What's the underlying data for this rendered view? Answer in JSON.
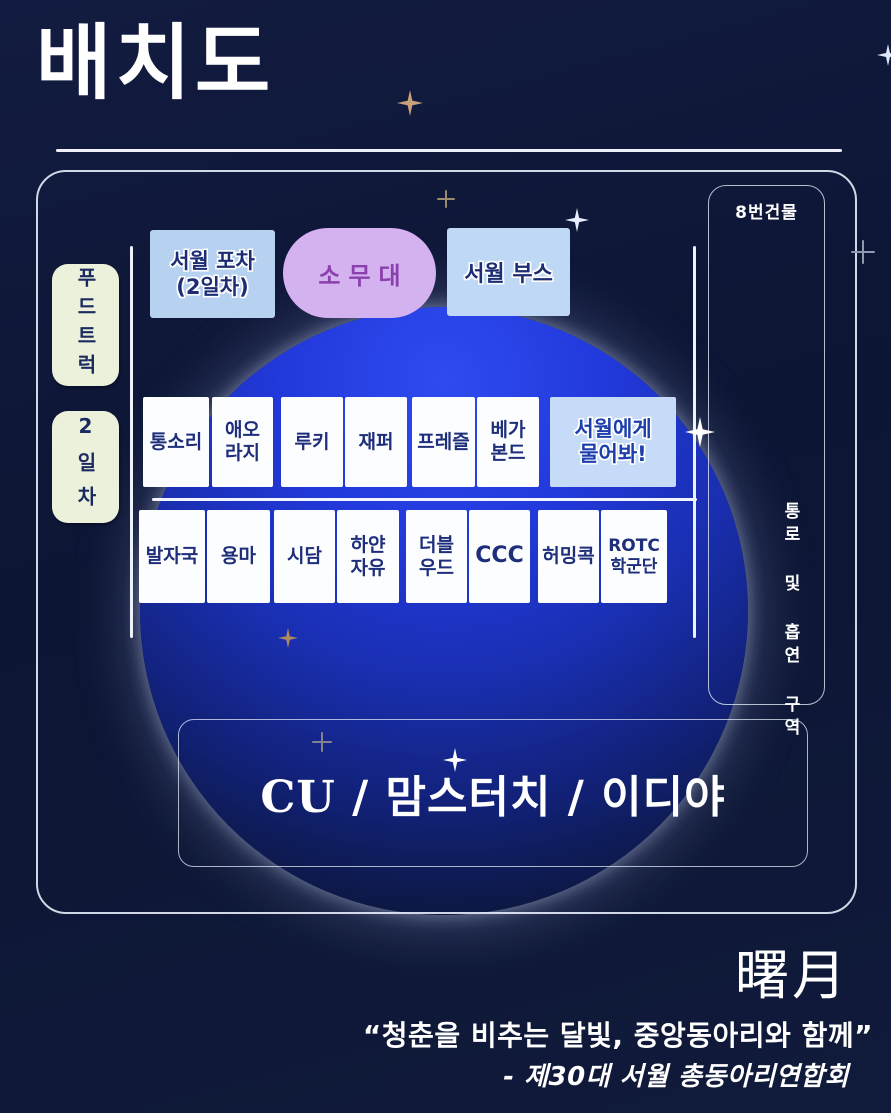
{
  "title": "배치도",
  "map": {
    "building_label": "8번건물",
    "corridor_label": "통로 및 흡연 구역",
    "food_truck_label": "푸드트럭",
    "day2_label": "2일차",
    "pocha": {
      "line1": "서월 포차",
      "line2": "(2일차)"
    },
    "stage_label": "소무대",
    "booth_label": "서월 부스",
    "row1": [
      {
        "label": "통소리"
      },
      {
        "line1": "애오",
        "line2": "라지"
      },
      {
        "label": "루키"
      },
      {
        "label": "재퍼"
      },
      {
        "label": "프레즐"
      },
      {
        "line1": "베가",
        "line2": "본드"
      },
      {
        "line1": "서월에게",
        "line2": "물어봐!"
      }
    ],
    "row2": [
      {
        "label": "발자국"
      },
      {
        "label": "용마"
      },
      {
        "label": "시담"
      },
      {
        "line1": "하얀",
        "line2": "자유"
      },
      {
        "line1": "더블",
        "line2": "우드"
      },
      {
        "label": "CCC"
      },
      {
        "label": "허밍콕"
      },
      {
        "line1": "ROTC",
        "line2": "학군단"
      }
    ],
    "stores_label": "CU / 맘스터치 / 이디야"
  },
  "footer": {
    "hanja": "曙月",
    "quote": "“청춘을 비추는 달빛, 중앙동아리와 함께”",
    "org": "- 제30대 서월 총동아리연합회"
  },
  "colors": {
    "background": "#0d1534",
    "moon_blue": "#2239dc",
    "light_blue_box": "#bed8f6",
    "lavender_box": "#d4b2ef",
    "cream_box": "#ecf1dc",
    "white_box": "#fcfdff",
    "navy_text": "#1e2e7a",
    "purple_text": "#8a41ad"
  }
}
